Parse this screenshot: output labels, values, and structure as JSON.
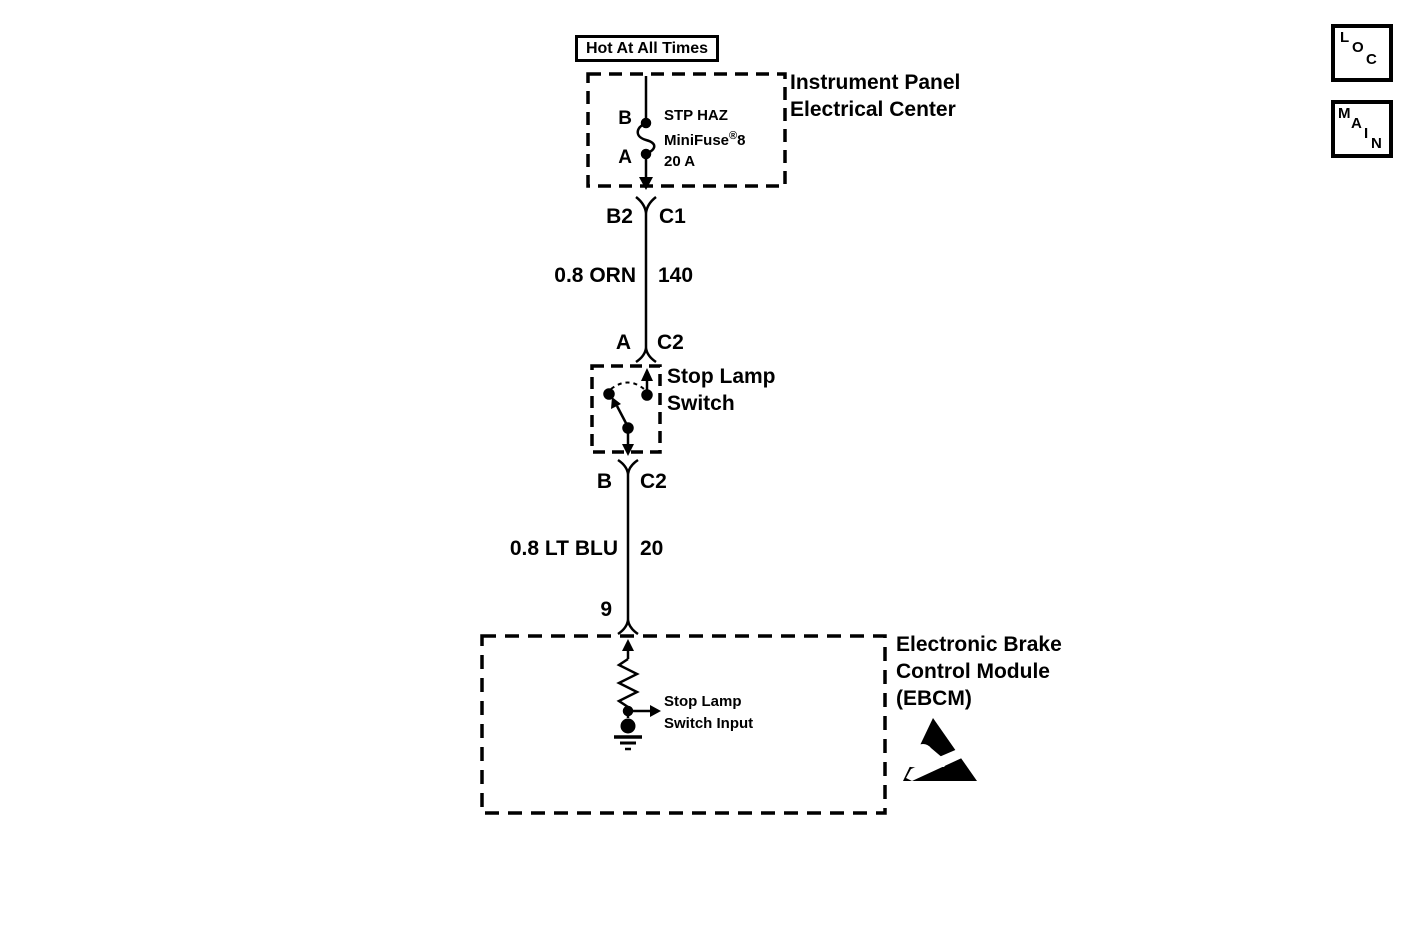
{
  "colors": {
    "ink": "#000000",
    "background": "#ffffff"
  },
  "symbols": {
    "fuse": "fuse-s-curve",
    "connector": "y-inline-connector",
    "switch": "spst-switch",
    "resistor": "zigzag-resistor",
    "ground": "chassis-ground",
    "esd": "esd-warning-triangle"
  },
  "nav": {
    "loc_letters": [
      "L",
      "O",
      "C"
    ],
    "main_letters": [
      "M",
      "A",
      "I",
      "N"
    ]
  },
  "diagram": {
    "power_label": "Hot At All Times",
    "ipec": {
      "title_lines": [
        "Instrument Panel",
        "Electrical Center"
      ],
      "fuse_terminal_top": "B",
      "fuse_terminal_bottom": "A",
      "fuse_line1": "STP HAZ",
      "fuse_line2_base": "MiniFuse",
      "fuse_line2_reg": "®",
      "fuse_line2_num": "8",
      "fuse_rating": "20 A"
    },
    "conn_ipec": {
      "left": "B2",
      "right": "C1"
    },
    "wire_orn": {
      "label": "0.8 ORN",
      "circuit": "140"
    },
    "conn_switch_in": {
      "left": "A",
      "right": "C2"
    },
    "switch": {
      "title_lines": [
        "Stop Lamp",
        "Switch"
      ]
    },
    "conn_switch_out": {
      "left": "B",
      "right": "C2"
    },
    "wire_ltblu": {
      "label": "0.8 LT BLU",
      "circuit": "20"
    },
    "ebcm": {
      "pin": "9",
      "title_lines": [
        "Electronic Brake",
        "Control Module",
        "(EBCM)"
      ],
      "input_lines": [
        "Stop Lamp",
        "Switch Input"
      ]
    }
  }
}
